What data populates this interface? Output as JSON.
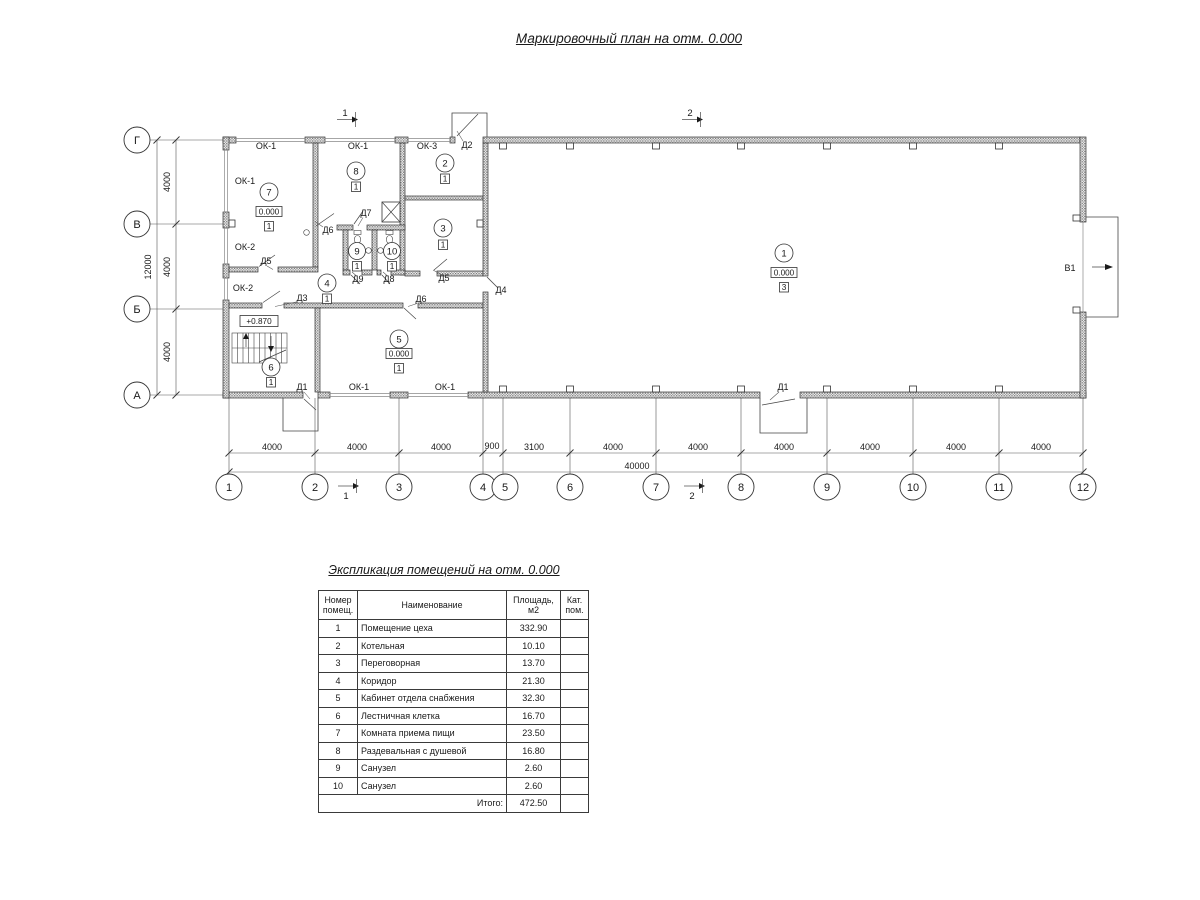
{
  "plan_title": "Маркировочный план на отм. 0.000",
  "plan": {
    "axis_letters": [
      "Г",
      "В",
      "Б",
      "А"
    ],
    "grid_numbers": [
      "1",
      "2",
      "3",
      "4",
      "5",
      "6",
      "7",
      "8",
      "9",
      "10",
      "11",
      "12"
    ],
    "dims_bottom": [
      "4000",
      "4000",
      "4000",
      "900",
      "3100",
      "4000",
      "4000",
      "4000",
      "4000",
      "4000",
      "4000"
    ],
    "total_bottom": "40000",
    "dims_left": [
      "4000",
      "4000",
      "4000"
    ],
    "total_left": "12000",
    "sections": {
      "s1": "1",
      "s2": "2"
    },
    "room_numbers": [
      "1",
      "2",
      "3",
      "4",
      "5",
      "6",
      "7",
      "8",
      "9",
      "10"
    ],
    "labels": {
      "ok1": "ОК-1",
      "ok2": "ОК-2",
      "ok3": "ОК-3",
      "d1": "Д1",
      "d2": "Д2",
      "d3": "Д3",
      "d4": "Д4",
      "d5": "Д5",
      "d6": "Д6",
      "d7": "Д7",
      "d8": "Д8",
      "d9": "Д9",
      "v1": "В1",
      "elev_zero": "0.000",
      "elev_stair": "+0.870",
      "cat1": "1",
      "cat3": "3"
    }
  },
  "table": {
    "title": "Экспликация помещений на отм. 0.000",
    "col_num": "Номер помещ.",
    "col_name": "Наименование",
    "col_area": "Площадь, м2",
    "col_cat": "Кат. пом.",
    "rows": [
      {
        "num": "1",
        "name": "Помещение цеха",
        "area": "332.90",
        "cat": ""
      },
      {
        "num": "2",
        "name": "Котельная",
        "area": "10.10",
        "cat": ""
      },
      {
        "num": "3",
        "name": "Переговорная",
        "area": "13.70",
        "cat": ""
      },
      {
        "num": "4",
        "name": "Коридор",
        "area": "21.30",
        "cat": ""
      },
      {
        "num": "5",
        "name": "Кабинет отдела снабжения",
        "area": "32.30",
        "cat": ""
      },
      {
        "num": "6",
        "name": "Лестничная клетка",
        "area": "16.70",
        "cat": ""
      },
      {
        "num": "7",
        "name": "Комната приема пищи",
        "area": "23.50",
        "cat": ""
      },
      {
        "num": "8",
        "name": "Раздевальная с душевой",
        "area": "16.80",
        "cat": ""
      },
      {
        "num": "9",
        "name": "Санузел",
        "area": "2.60",
        "cat": ""
      },
      {
        "num": "10",
        "name": "Санузел",
        "area": "2.60",
        "cat": ""
      }
    ],
    "total_label": "Итого:",
    "total_value": "472.50"
  }
}
